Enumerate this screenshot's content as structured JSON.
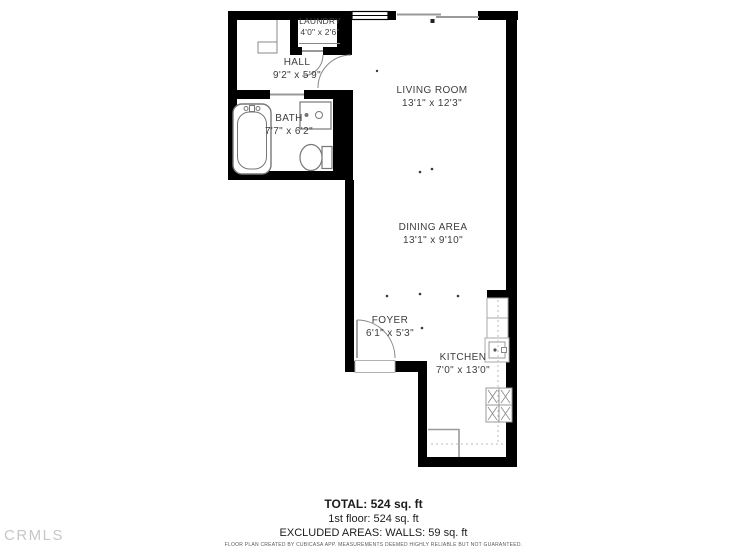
{
  "floorplan": {
    "rooms": [
      {
        "id": "laundry",
        "name": "LAUNDRY",
        "dims": "4'0\" x 2'6\""
      },
      {
        "id": "hall",
        "name": "HALL",
        "dims": "9'2\" x 5'9\""
      },
      {
        "id": "bath",
        "name": "BATH",
        "dims": "7'7\" x 6'2\""
      },
      {
        "id": "living_room",
        "name": "LIVING ROOM",
        "dims": "13'1\" x 12'3\""
      },
      {
        "id": "dining_area",
        "name": "DINING AREA",
        "dims": "13'1\" x 9'10\""
      },
      {
        "id": "foyer",
        "name": "FOYER",
        "dims": "6'1\" x 5'3\""
      },
      {
        "id": "kitchen",
        "name": "KITCHEN",
        "dims": "7'0\" x 13'0\""
      }
    ],
    "fixtures": [
      "bathtub-icon",
      "bath-sink-icon",
      "toilet-icon",
      "kitchen-sink-icon",
      "stove-icon",
      "counter",
      "window",
      "door-arc"
    ]
  },
  "summary": {
    "total": "TOTAL: 524 sq. ft",
    "floor1": "1st floor: 524 sq. ft",
    "excluded": "EXCLUDED AREAS: WALLS: 59 sq. ft"
  },
  "footer": {
    "disclaimer": "FLOOR PLAN CREATED BY CUBICASA APP. MEASUREMENTS DEEMED HIGHLY RELIABLE BUT NOT GUARANTEED."
  },
  "watermark": "CRMLS",
  "colors": {
    "wall": "#000000",
    "fixture_line": "#888888",
    "counter_line": "#aaaaaa",
    "label_text": "#3d3d3d",
    "watermark_text": "#c7c7c7",
    "disclaimer_text": "#5a5a5a"
  }
}
